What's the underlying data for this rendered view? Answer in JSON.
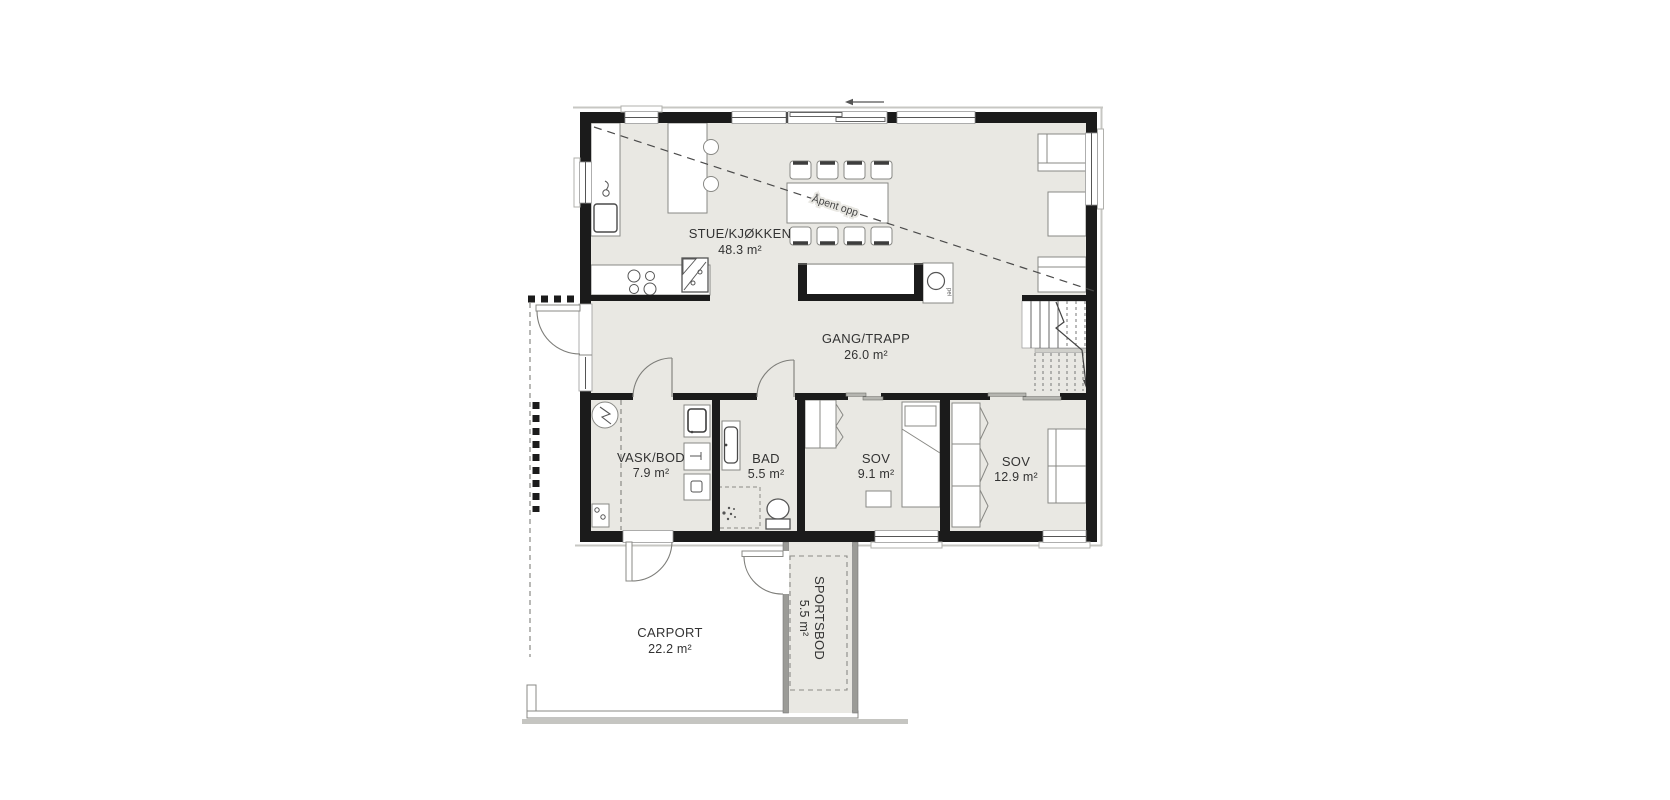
{
  "plan": {
    "rooms": [
      {
        "id": "stue-kjokken",
        "name": "STUE/KJØKKEN",
        "area": "48.3 m²"
      },
      {
        "id": "gang-trapp",
        "name": "GANG/TRAPP",
        "area": "26.0 m²"
      },
      {
        "id": "vask-bod",
        "name": "VASK/BOD",
        "area": "7.9 m²"
      },
      {
        "id": "bad",
        "name": "BAD",
        "area": "5.5 m²"
      },
      {
        "id": "sov-liten",
        "name": "SOV",
        "area": "9.1 m²"
      },
      {
        "id": "sov-stor",
        "name": "SOV",
        "area": "12.9 m²"
      },
      {
        "id": "carport",
        "name": "CARPORT",
        "area": "22.2 m²"
      },
      {
        "id": "sportsbod",
        "name": "SPORTSBOD",
        "area": "5.5 m²"
      }
    ],
    "annotations": {
      "open_above": "Åpent opp",
      "fireplace": "pei"
    },
    "colors": {
      "wall": "#1b1b1b",
      "floor": "#e9e8e3",
      "furniture_outline": "#888884",
      "text": "#333333"
    }
  }
}
